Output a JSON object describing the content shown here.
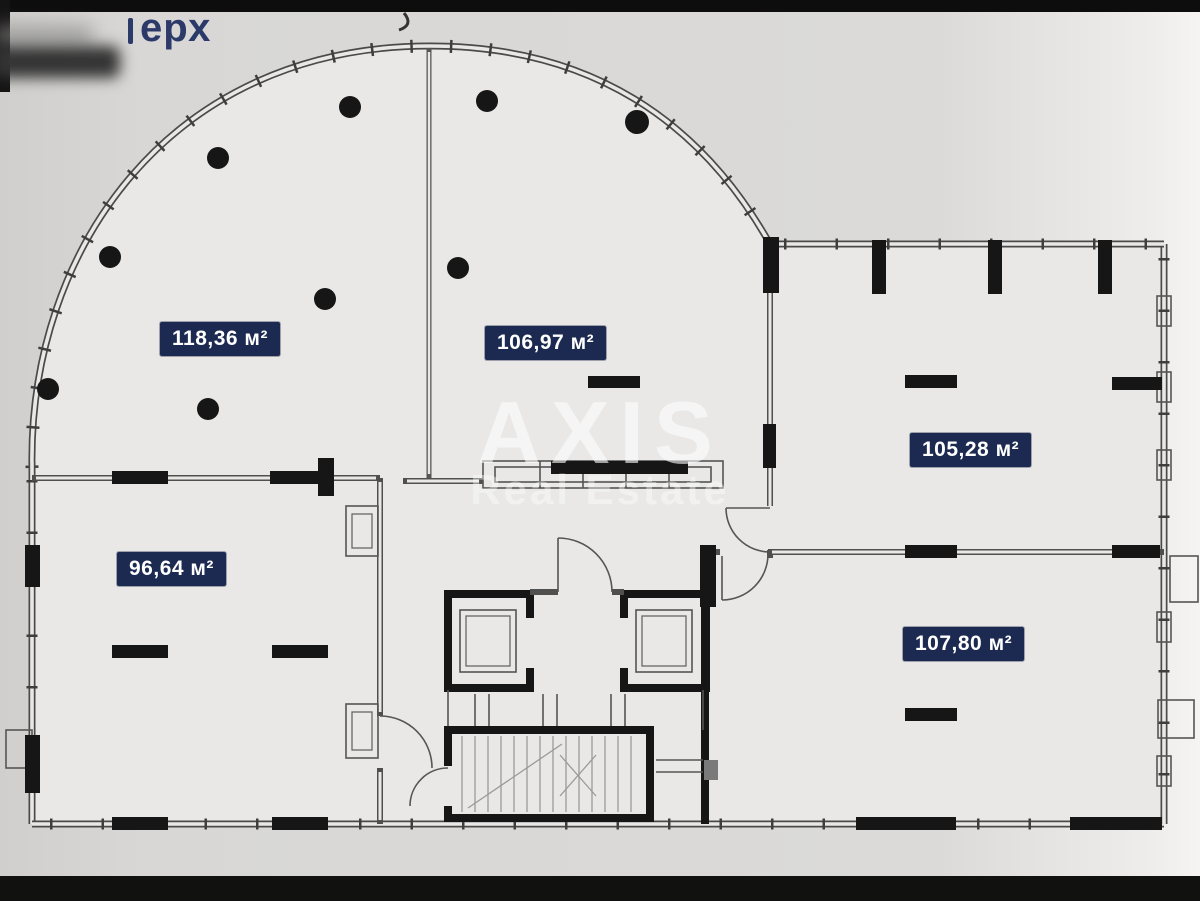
{
  "header": {
    "handwritten_fragment": "ерх"
  },
  "watermark": {
    "primary": "AXIS",
    "secondary": "Real Estate"
  },
  "rooms": [
    {
      "id": "room-top-left",
      "area": "118,36 м²"
    },
    {
      "id": "room-top-center",
      "area": "106,97 м²"
    },
    {
      "id": "room-right-upper",
      "area": "105,28 м²"
    },
    {
      "id": "room-bottom-left",
      "area": "96,64 м²"
    },
    {
      "id": "room-right-lower",
      "area": "107,80 м²"
    }
  ],
  "colors": {
    "label_bg": "#1c2a52",
    "label_text": "#ffffff",
    "wall_line": "#4a4a4a",
    "pier_black": "#161616",
    "paper": "#d8d7d5",
    "interior": "#e9e8e6",
    "handwriting": "#2c3a6a",
    "watermark": "#ffffff"
  }
}
